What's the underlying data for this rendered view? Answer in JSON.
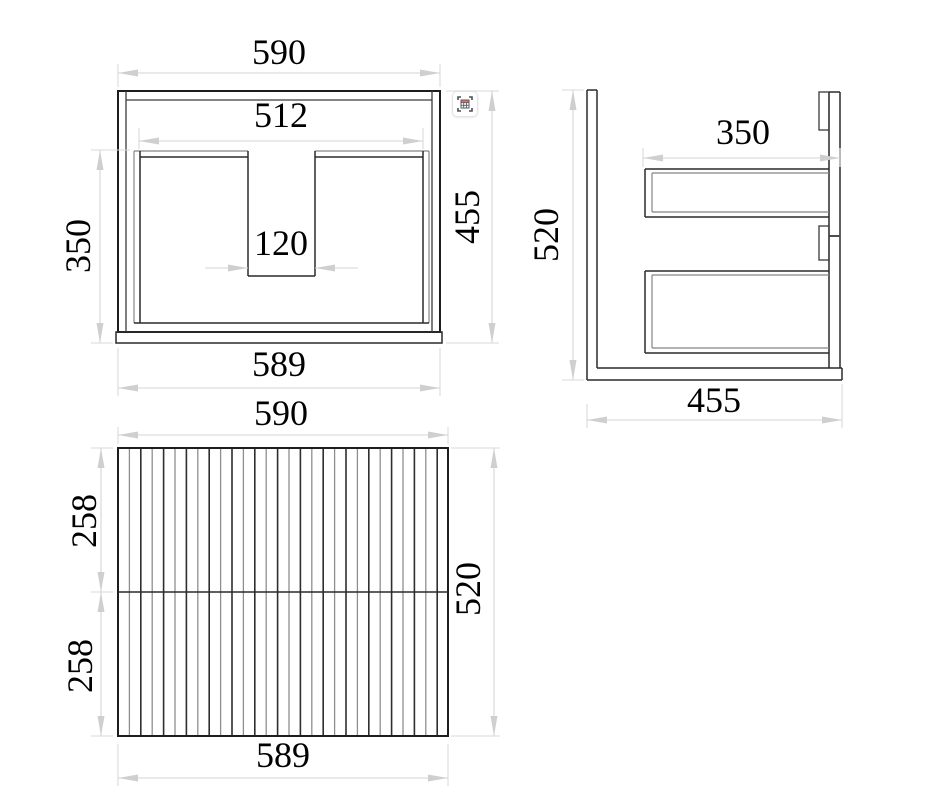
{
  "colors": {
    "outline": "#1d1d1d",
    "secondary_line": "#858585",
    "dimension_gray": "#d5d5d5",
    "text": "#000000",
    "icon_accent": "#e8705f"
  },
  "views": {
    "plan": {
      "title": "plan-view",
      "dims": {
        "overall_width": "590",
        "inner_width": "512",
        "notch_width": "120",
        "basin_depth": "350",
        "overall_depth": "455",
        "front_edge_width": "589"
      }
    },
    "side": {
      "title": "side-view",
      "dims": {
        "drawer_depth": "350",
        "overall_height": "520",
        "overall_depth": "455"
      }
    },
    "front": {
      "title": "front-view",
      "dims": {
        "overall_width": "590",
        "upper_drawer_height": "258",
        "lower_drawer_height": "258",
        "overall_height": "520",
        "bottom_width": "589"
      }
    }
  },
  "capture_button": {
    "icon": "table-capture-icon"
  }
}
